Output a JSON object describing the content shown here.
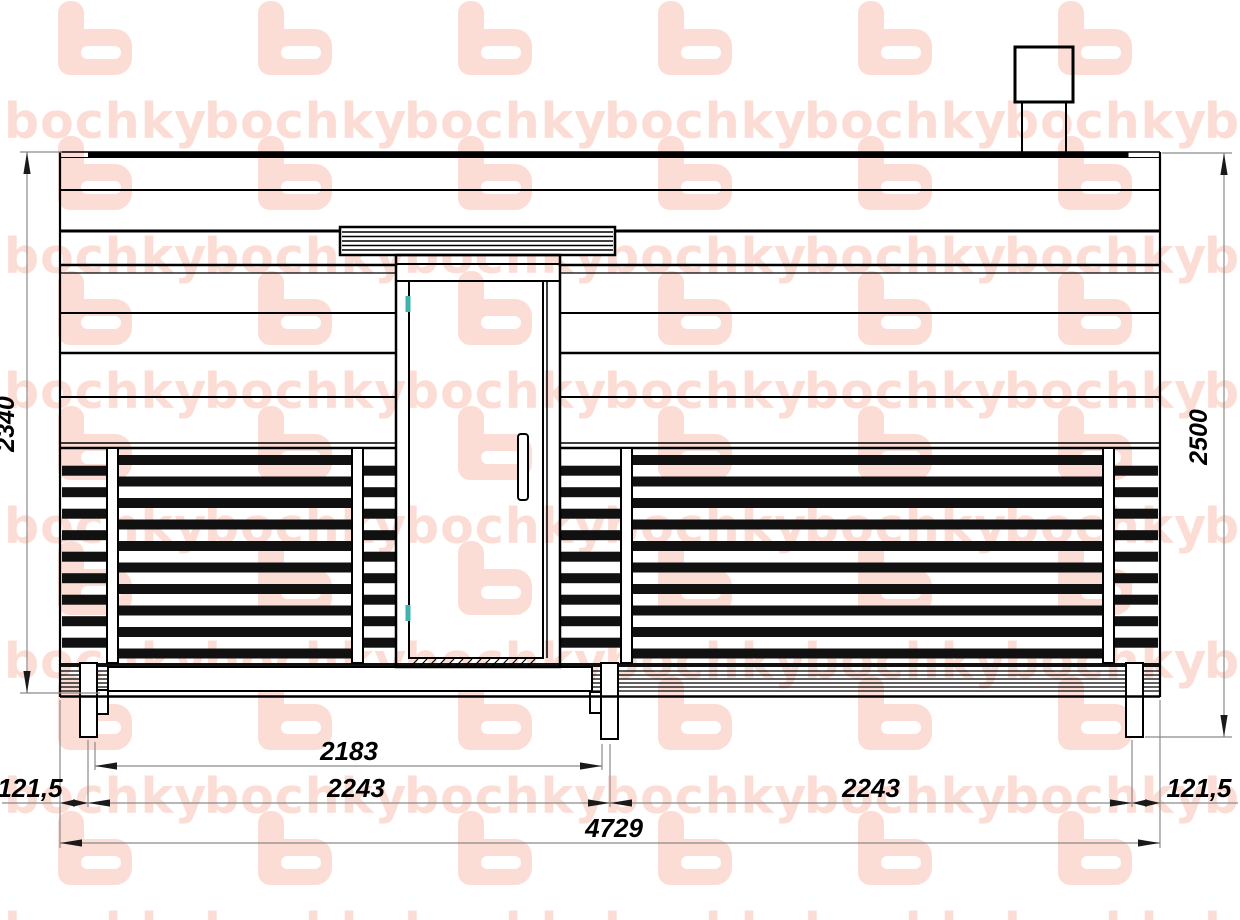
{
  "watermark": {
    "letter": "b",
    "word": "bochky",
    "mark": "°",
    "color": "#fcddd5"
  },
  "drawing": {
    "dimensions": {
      "height_wall": "2340",
      "height_total": "2500",
      "span_clear": "2183",
      "module_left": "2243",
      "module_right": "2243",
      "offset_left": "121,5",
      "offset_right": "121,5",
      "length_total": "4729"
    },
    "colors": {
      "line": "#000000",
      "dim_line": "#8a8a8a",
      "arrow": "#1a1a1a",
      "hinge": "#3fb3ad"
    }
  }
}
